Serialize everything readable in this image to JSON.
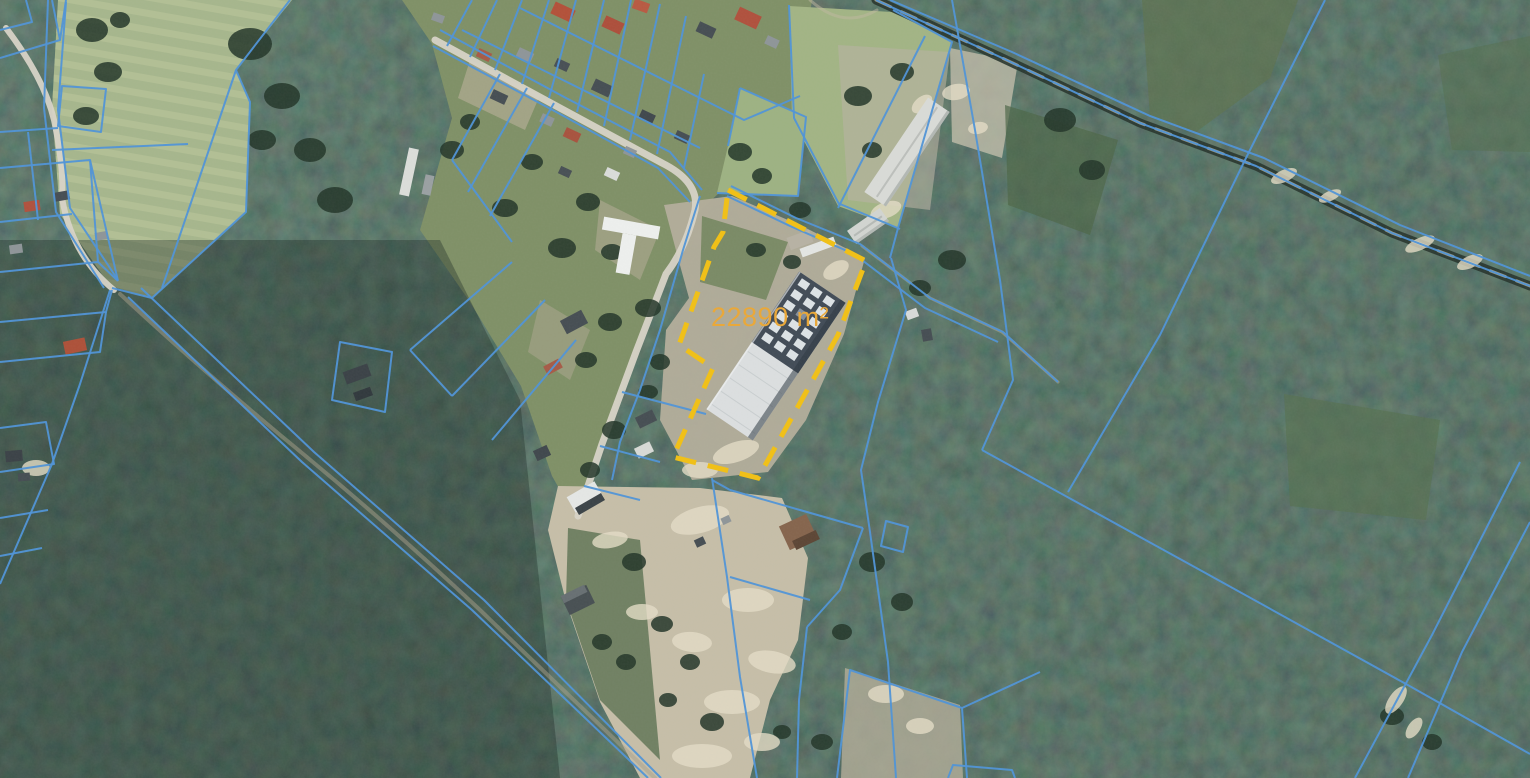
{
  "map": {
    "parcel": {
      "area_label": "22890 m²",
      "outline_points": "728,190 866,261 838,335 758,478 673,457 713,368 679,345 714,247 723,232",
      "stroke": "#f0c019",
      "stroke_width": 5,
      "dash": "21 12",
      "label_color": "#e9a83a",
      "label_x": 711,
      "label_y": 326,
      "label_font_size": 27
    },
    "palette": {
      "cadastral_blue": "#4f93d7",
      "highlight_yellow": "#f0c019",
      "label_amber": "#e9a83a",
      "forest_dark": "#243830",
      "village_grass": "#7f9066",
      "field_pale": "#a6b68c",
      "sand": "#c6bea8",
      "road_light": "#d8d4c7"
    },
    "regions": [
      {
        "name": "field-northwest",
        "points": "58,0 292,0 236,70 250,102 246,212 152,298 110,286 60,214 52,108",
        "fill": "#a6b68c",
        "opacity": 1
      },
      {
        "name": "field-stripes",
        "points": "58,0 292,0 236,70 250,102 246,212 152,298 110,286 60,214 52,108",
        "fill": "url(#fieldStripes)",
        "opacity": 0.55
      },
      {
        "name": "village-zone",
        "points": "402,0 812,0 798,96 772,186 718,194 696,214 670,268 638,350 602,444 576,518 552,476 521,386 470,302 420,230 452,118 432,44",
        "fill": "#7f9066",
        "opacity": 1
      },
      {
        "name": "pasture-a",
        "points": "740,88 806,117 798,196 717,193 728,146",
        "fill": "#9db282",
        "opacity": 1
      },
      {
        "name": "pasture-b",
        "points": "789,6 893,12 952,42 898,228 838,206 792,118",
        "fill": "#a2b484",
        "opacity": 1
      },
      {
        "name": "sand-around-parcel",
        "points": "664,205 732,196 802,226 865,258 844,334 806,420 768,472 692,480 660,420 666,330 689,298 678,258",
        "fill": "#b4ae9b",
        "opacity": 0.95
      },
      {
        "name": "green-in-parcel",
        "points": "702,216 788,242 766,300 700,282",
        "fill": "#74865f",
        "opacity": 0.9
      },
      {
        "name": "sand-corridor",
        "points": "558,486 700,488 782,498 808,558 798,640 770,700 750,778 640,778 600,702 566,602 548,530",
        "fill": "#c6bea8",
        "opacity": 1
      },
      {
        "name": "green-strips-corridor",
        "points": "568,528 640,540 660,760 600,700 566,600",
        "fill": "#5a7150",
        "opacity": 0.8
      },
      {
        "name": "clearing-barn",
        "points": "838,45 950,52 930,210 848,200",
        "fill": "#b8b3a1",
        "opacity": 0.6
      },
      {
        "name": "clearing-east",
        "points": "950,48 1018,62 1002,158 952,142",
        "fill": "#c8c1ad",
        "opacity": 0.75
      },
      {
        "name": "clearing-bottom",
        "points": "845,668 960,705 963,778 841,778",
        "fill": "#b3ac98",
        "opacity": 0.8
      },
      {
        "name": "clearcut-topright",
        "points": "1142,0 1298,0 1270,78 1196,132 1150,118",
        "fill": "#5d7350",
        "opacity": 0.75
      },
      {
        "name": "clearcut-corner",
        "points": "1438,55 1530,36 1530,152 1452,150",
        "fill": "#557050",
        "opacity": 0.55
      },
      {
        "name": "clearcut-midright",
        "points": "1284,394 1440,420 1426,520 1290,506",
        "fill": "#567050",
        "opacity": 0.65
      },
      {
        "name": "clearcut-nearright",
        "points": "1005,105 1118,140 1090,235 1008,205",
        "fill": "#4d6647",
        "opacity": 0.7
      },
      {
        "name": "dirt-village-1",
        "points": "470,60 540,95 525,130 458,98",
        "fill": "#b9b09a",
        "opacity": 0.6
      },
      {
        "name": "dirt-village-2",
        "points": "600,200 660,230 640,280 595,250",
        "fill": "#b5ac96",
        "opacity": 0.55
      },
      {
        "name": "dirt-village-3",
        "points": "540,300 590,330 570,380 528,352",
        "fill": "#b0a792",
        "opacity": 0.5
      },
      {
        "name": "darken-southwest",
        "points": "0,240 440,240 520,400 560,778 0,778",
        "fill": "#17251f",
        "opacity": 0.35
      }
    ],
    "roads": [
      {
        "name": "west-curvy-road",
        "d": "M 6,28 Q 44,78 54,120 Q 64,168 62,198 Q 72,256 114,290",
        "stroke": "#d8d4c7",
        "width": 6,
        "opacity": 0.95
      },
      {
        "name": "forest-dirt-road",
        "d": "M 120,294 Q 215,382 308,458 Q 395,530 480,610 L 655,778",
        "stroke": "#a79f89",
        "width": 4,
        "opacity": 0.5
      },
      {
        "name": "main-street",
        "d": "M 435,40 L 560,108 L 662,163 Q 700,182 695,210 Q 686,248 666,274 L 636,352 L 602,444 L 578,516",
        "stroke": "#d8d4c7",
        "width": 7,
        "opacity": 0.95
      },
      {
        "name": "forest-road-dark",
        "d": "M 876,0 L 1000,57 L 1140,123 L 1256,166 L 1392,233 L 1530,286",
        "stroke": "#27342c",
        "width": 9,
        "opacity": 0.9
      },
      {
        "name": "forest-road-tan",
        "d": "M 876,0 L 1000,57 L 1140,123 L 1256,166 L 1392,233 L 1530,286",
        "stroke": "#b3a98d",
        "width": 3,
        "opacity": 0.85,
        "dash": "16 12"
      },
      {
        "name": "track-northeast",
        "d": "M 862,246 L 930,298 L 1002,332 L 1058,382",
        "stroke": "#b0a88f",
        "width": 3,
        "opacity": 0.55
      },
      {
        "name": "track-top-entry",
        "d": "M 810,0 Q 843,30 877,10",
        "stroke": "#c0b89f",
        "width": 3,
        "opacity": 0.5
      }
    ],
    "cadastral_line_style": {
      "stroke": "#4f93d7",
      "width": 2,
      "opacity": 0.95
    },
    "cadastral_lines": [
      "M 0,58 L 60,40 L 52,0",
      "M 26,0 L 32,22 L 0,30",
      "M 60,40 L 66,0",
      "M 48,0 L 44,108 L 56,212 L 104,288",
      "M 66,2 L 58,110 L 70,208 L 118,280",
      "M 290,0 L 236,70 L 250,102 L 246,212 L 152,298 L 112,288",
      "M 236,70 L 162,288",
      "M 62,86 L 106,89 L 101,132 L 58,126 Z",
      "M 52,150 L 188,144",
      "M 0,132 L 58,128",
      "M 0,168 L 90,160 L 118,281",
      "M 0,222 L 72,214",
      "M 28,132 L 38,220",
      "M 90,160 L 98,262 L 0,272",
      "M 98,262 L 118,281",
      "M 0,322 L 106,312 L 112,290",
      "M 0,362 L 100,352 L 106,312",
      "M 110,290 L 80,384 L 52,464 L 0,584",
      "M 0,428 L 46,422 L 54,464 L 0,472",
      "M 0,518 L 48,510",
      "M 0,556 L 42,548",
      "M 128,297 L 302,462 L 472,610 L 648,778",
      "M 141,288 L 314,452 L 484,600 L 661,778",
      "M 433,46 L 560,114 L 658,168 L 690,202",
      "M 440,30 L 566,98 L 670,152 L 702,190",
      "M 462,30 L 700,148",
      "M 520,8 L 704,100",
      "M 447,46 L 472,0",
      "M 470,57 L 497,0",
      "M 495,70 L 522,0",
      "M 522,84 L 549,0",
      "M 549,98 L 576,0",
      "M 577,112 L 604,0",
      "M 604,126 L 631,0",
      "M 630,140 L 660,4",
      "M 657,154 L 686,16",
      "M 684,168 L 704,74",
      "M 704,100 L 744,120 L 800,96",
      "M 740,88 L 806,117 L 798,196 L 717,193",
      "M 728,146 L 740,88",
      "M 789,5 L 794,118 L 840,206",
      "M 925,36 L 838,208",
      "M 840,204 L 900,229",
      "M 893,10 L 952,42 L 898,228",
      "M 500,74 L 452,160",
      "M 527,88 L 468,192",
      "M 554,103 L 490,216",
      "M 452,160 L 512,242",
      "M 512,262 L 410,350",
      "M 545,300 L 452,396",
      "M 576,340 L 492,440",
      "M 410,350 L 452,396",
      "M 340,342 L 392,352 L 385,412 L 332,400 Z",
      "M 622,392 L 706,414",
      "M 600,446 L 660,462",
      "M 584,486 L 640,500",
      "M 700,196 L 683,250 L 660,330 L 640,390 L 620,442 L 612,480",
      "M 731,186 L 796,218 L 860,244 L 930,298 L 1003,332 L 1058,382",
      "M 727,196 L 790,226 L 854,254 L 925,308 L 998,342",
      "M 898,228 L 890,258",
      "M 891,258 L 906,310 L 878,402 L 861,470 L 870,532 L 888,662 L 896,778",
      "M 886,521 L 908,527 L 903,552 L 881,546 Z",
      "M 712,478 L 727,577 L 740,677 L 757,778",
      "M 712,480 L 730,490",
      "M 730,490 L 800,510 L 863,528",
      "M 863,528 L 840,590 L 807,627",
      "M 807,627 L 799,700 L 797,778",
      "M 730,577 L 810,600",
      "M 837,778 L 850,670 L 962,708 L 967,778",
      "M 962,708 L 1040,672",
      "M 876,0 L 1000,57 L 1140,123 L 1256,166 L 1392,233 L 1530,286",
      "M 890,0 L 1012,52 L 1150,116 L 1264,158 L 1400,225 L 1530,276",
      "M 952,0 L 975,130 L 1000,280 L 1013,380 L 982,450",
      "M 982,450 L 1200,570 L 1406,684 L 1530,754",
      "M 1325,0 L 1245,160 L 1160,335 L 1068,492",
      "M 1520,462 L 1432,635 L 1355,778",
      "M 1530,522 L 1462,652 L 1408,778",
      "M 948,778 L 953,765 L 1012,770 L 1015,778"
    ],
    "buildings": [
      [
        563,
        12,
        22,
        13,
        25,
        "#b35038"
      ],
      [
        613,
        25,
        20,
        12,
        25,
        "#ad4e3a"
      ],
      [
        641,
        6,
        16,
        10,
        20,
        "#b85941"
      ],
      [
        706,
        30,
        18,
        11,
        25,
        "#454d52"
      ],
      [
        748,
        18,
        24,
        14,
        25,
        "#b0503c"
      ],
      [
        772,
        42,
        13,
        9,
        25,
        "#8e9598"
      ],
      [
        525,
        55,
        16,
        10,
        25,
        "#8e9598"
      ],
      [
        562,
        65,
        14,
        9,
        25,
        "#474f54"
      ],
      [
        484,
        55,
        14,
        9,
        25,
        "#a65a46"
      ],
      [
        438,
        18,
        12,
        8,
        20,
        "#8e9598"
      ],
      [
        499,
        97,
        16,
        10,
        25,
        "#454d52"
      ],
      [
        547,
        120,
        13,
        9,
        25,
        "#8e9598"
      ],
      [
        602,
        88,
        19,
        12,
        25,
        "#454d52"
      ],
      [
        647,
        117,
        15,
        10,
        25,
        "#3f474c"
      ],
      [
        630,
        152,
        12,
        8,
        25,
        "#8e9598"
      ],
      [
        682,
        137,
        14,
        9,
        25,
        "#454d52"
      ],
      [
        572,
        135,
        16,
        10,
        25,
        "#a8523e"
      ],
      [
        612,
        174,
        14,
        9,
        25,
        "#dadcda"
      ],
      [
        565,
        172,
        12,
        8,
        25,
        "#474f54"
      ],
      [
        409,
        172,
        10,
        48,
        12,
        "#dcdeda"
      ],
      [
        428,
        185,
        9,
        20,
        12,
        "#9aa0a2"
      ],
      [
        574,
        322,
        24,
        15,
        -28,
        "#454d52"
      ],
      [
        553,
        367,
        17,
        10,
        -28,
        "#a65a46"
      ],
      [
        542,
        453,
        15,
        11,
        -25,
        "#3f474c"
      ],
      [
        646,
        419,
        19,
        12,
        -26,
        "#454d52"
      ],
      [
        644,
        450,
        17,
        11,
        -26,
        "#d8dad6"
      ],
      [
        357,
        374,
        26,
        13,
        -20,
        "#3a4146"
      ],
      [
        363,
        394,
        18,
        9,
        -20,
        "#30383c"
      ],
      [
        75,
        346,
        22,
        13,
        -12,
        "#ad5038"
      ],
      [
        32,
        206,
        16,
        10,
        -8,
        "#b0503c"
      ],
      [
        16,
        249,
        13,
        9,
        -8,
        "#8e9598"
      ],
      [
        62,
        196,
        15,
        9,
        -10,
        "#454d52"
      ],
      [
        101,
        236,
        12,
        8,
        -10,
        "#8e9598"
      ],
      [
        14,
        456,
        17,
        11,
        -5,
        "#3a4146"
      ],
      [
        24,
        477,
        12,
        8,
        -5,
        "#454d52"
      ],
      [
        585,
        497,
        32,
        18,
        -30,
        "#e5e7e5"
      ],
      [
        590,
        504,
        30,
        8,
        -30,
        "#3a4246"
      ],
      [
        578,
        600,
        28,
        20,
        -26,
        "#474f52"
      ],
      [
        574,
        594,
        26,
        8,
        -26,
        "#676f72"
      ],
      [
        798,
        532,
        30,
        26,
        -25,
        "#85644c"
      ],
      [
        806,
        540,
        26,
        10,
        -25,
        "#5c4534"
      ],
      [
        700,
        542,
        10,
        8,
        -25,
        "#454d52"
      ],
      [
        726,
        520,
        9,
        7,
        -25,
        "#8e9598"
      ],
      [
        818,
        247,
        36,
        9,
        -20,
        "#e4e6e3"
      ],
      [
        800,
        240,
        24,
        13,
        -20,
        "#b7b2a3"
      ],
      [
        912,
        314,
        12,
        9,
        -20,
        "#d8dad8"
      ],
      [
        927,
        335,
        10,
        12,
        -10,
        "#454d52"
      ]
    ],
    "warehouse": {
      "cx": 776,
      "cy": 356,
      "rot": -56,
      "length": 166,
      "width": 56,
      "light": "#dcdfe0",
      "dark": "#414b56",
      "unit_fill": "#e6ebee",
      "unit_alt": "#8994a0",
      "ridge": "#c2c8c9",
      "shadow": "#2e3842"
    },
    "barn": {
      "cx": 907,
      "cy": 152,
      "rot": -56,
      "length": 114,
      "width": 26,
      "fill": "#d9dbd7",
      "ridge": "#b9bdb9",
      "shadow": "#9aa09c"
    },
    "barn_small": {
      "cx": 868,
      "cy": 226,
      "rot": -35,
      "length": 40,
      "width": 16,
      "fill": "#d2d5d1",
      "ridge": "#b4b8b4",
      "shadow": "#a0a6a2"
    },
    "t_building": {
      "cx": 626,
      "cy": 254,
      "rot": 10,
      "bar": [
        -28,
        -33,
        57,
        13
      ],
      "stem": [
        -7,
        -20,
        14,
        40
      ],
      "fill": "#eef0ee"
    },
    "trees": [
      [
        92,
        30,
        16,
        12
      ],
      [
        108,
        72,
        14,
        10
      ],
      [
        86,
        116,
        13,
        9
      ],
      [
        120,
        20,
        10,
        8
      ],
      [
        250,
        44,
        22,
        16
      ],
      [
        282,
        96,
        18,
        13
      ],
      [
        310,
        150,
        16,
        12
      ],
      [
        262,
        140,
        14,
        10
      ],
      [
        335,
        200,
        18,
        13
      ],
      [
        452,
        150,
        12,
        9
      ],
      [
        470,
        122,
        10,
        8
      ],
      [
        505,
        208,
        13,
        9
      ],
      [
        532,
        162,
        11,
        8
      ],
      [
        562,
        248,
        14,
        10
      ],
      [
        588,
        202,
        12,
        9
      ],
      [
        612,
        252,
        11,
        8
      ],
      [
        648,
        308,
        13,
        9
      ],
      [
        610,
        322,
        12,
        9
      ],
      [
        660,
        362,
        10,
        8
      ],
      [
        586,
        360,
        11,
        8
      ],
      [
        614,
        430,
        12,
        9
      ],
      [
        590,
        470,
        10,
        8
      ],
      [
        648,
        392,
        10,
        7
      ],
      [
        740,
        152,
        12,
        9
      ],
      [
        762,
        176,
        10,
        8
      ],
      [
        800,
        210,
        11,
        8
      ],
      [
        756,
        250,
        10,
        7
      ],
      [
        792,
        262,
        9,
        7
      ],
      [
        858,
        96,
        14,
        10
      ],
      [
        902,
        72,
        12,
        9
      ],
      [
        872,
        150,
        10,
        8
      ],
      [
        952,
        260,
        14,
        10
      ],
      [
        920,
        288,
        11,
        8
      ],
      [
        634,
        562,
        12,
        9
      ],
      [
        662,
        624,
        11,
        8
      ],
      [
        690,
        662,
        10,
        8
      ],
      [
        626,
        662,
        10,
        8
      ],
      [
        712,
        722,
        12,
        9
      ],
      [
        602,
        642,
        10,
        8
      ],
      [
        668,
        700,
        9,
        7
      ],
      [
        872,
        562,
        13,
        10
      ],
      [
        902,
        602,
        11,
        9
      ],
      [
        842,
        632,
        10,
        8
      ],
      [
        822,
        742,
        11,
        8
      ],
      [
        782,
        732,
        9,
        7
      ],
      [
        1392,
        716,
        12,
        9
      ],
      [
        1432,
        742,
        10,
        8
      ],
      [
        1060,
        120,
        16,
        12
      ],
      [
        1092,
        170,
        13,
        10
      ]
    ],
    "sand_patches": [
      [
        700,
        520,
        30,
        13,
        -15
      ],
      [
        748,
        600,
        26,
        12,
        0
      ],
      [
        692,
        642,
        20,
        10,
        5
      ],
      [
        772,
        662,
        24,
        11,
        10
      ],
      [
        642,
        612,
        16,
        8,
        0
      ],
      [
        732,
        702,
        28,
        12,
        0
      ],
      [
        702,
        756,
        30,
        12,
        0
      ],
      [
        762,
        742,
        18,
        9,
        0
      ],
      [
        610,
        540,
        18,
        8,
        -10
      ],
      [
        736,
        452,
        24,
        10,
        -18
      ],
      [
        806,
        296,
        16,
        9,
        -30
      ],
      [
        836,
        270,
        14,
        8,
        -30
      ],
      [
        700,
        470,
        18,
        8,
        0
      ],
      [
        886,
        210,
        16,
        8,
        -20
      ],
      [
        922,
        104,
        12,
        7,
        -40
      ],
      [
        1284,
        176,
        14,
        6,
        -25
      ],
      [
        1330,
        196,
        12,
        5,
        -25
      ],
      [
        1420,
        244,
        16,
        6,
        -25
      ],
      [
        1470,
        262,
        14,
        6,
        -25
      ],
      [
        1396,
        700,
        16,
        7,
        -55
      ],
      [
        1414,
        728,
        12,
        6,
        -55
      ],
      [
        956,
        92,
        14,
        8,
        -10
      ],
      [
        978,
        128,
        10,
        6,
        -10
      ],
      [
        36,
        468,
        14,
        8,
        0
      ],
      [
        886,
        694,
        18,
        9,
        0
      ],
      [
        920,
        726,
        14,
        8,
        0
      ]
    ]
  }
}
